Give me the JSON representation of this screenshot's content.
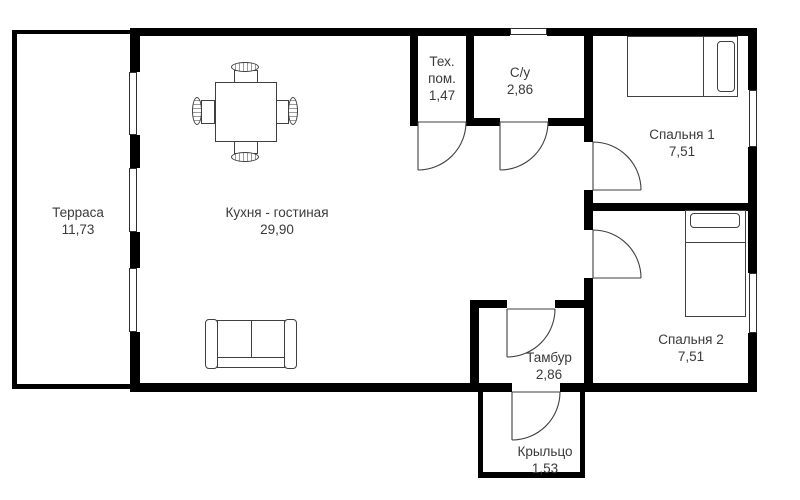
{
  "floor_plan": {
    "rooms": [
      {
        "id": "terrace",
        "name": "Терраса",
        "area": "11,73"
      },
      {
        "id": "kitchen-living",
        "name": "Кухня - гостиная",
        "area": "29,90"
      },
      {
        "id": "tech-room",
        "name": "Тех. пом.",
        "area": "1,47"
      },
      {
        "id": "bathroom",
        "name": "С/у",
        "area": "2,86"
      },
      {
        "id": "bedroom-1",
        "name": "Спальня 1",
        "area": "7,51"
      },
      {
        "id": "bedroom-2",
        "name": "Спальня 2",
        "area": "7,51"
      },
      {
        "id": "vestibule",
        "name": "Тамбур",
        "area": "2,86"
      },
      {
        "id": "porch",
        "name": "Крыльцо",
        "area": "1,53"
      }
    ],
    "colors": {
      "wall": "#000000",
      "line": "#3f3f3f",
      "text": "#3a3a3a",
      "background": "#ffffff"
    }
  }
}
